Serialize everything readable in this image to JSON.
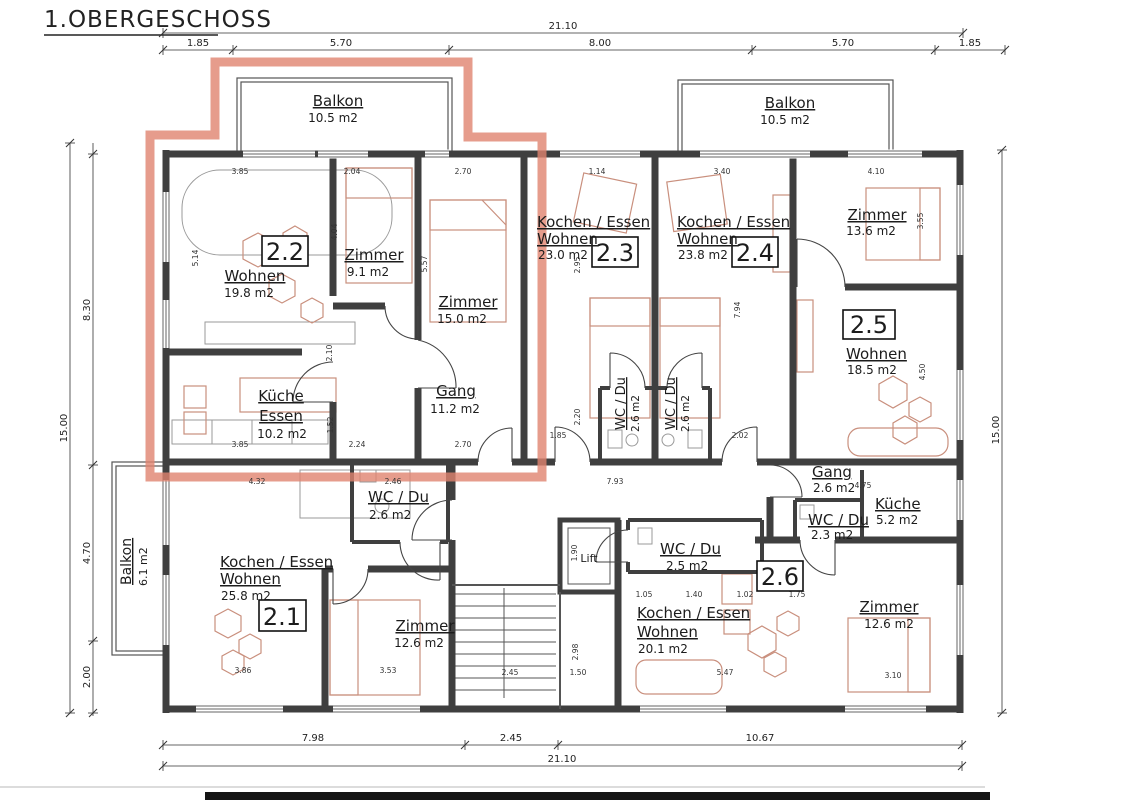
{
  "title": "1.OBERGESCHOSS",
  "highlight": {
    "unit": "2.2",
    "color": "#e0836f"
  },
  "units": [
    {
      "no": "2.1"
    },
    {
      "no": "2.2"
    },
    {
      "no": "2.3"
    },
    {
      "no": "2.4"
    },
    {
      "no": "2.5"
    },
    {
      "no": "2.6"
    }
  ],
  "rooms": [
    {
      "name": "Balkon",
      "area": "10.5 m2"
    },
    {
      "name": "Balkon",
      "area": "10.5 m2"
    },
    {
      "name": "Wohnen",
      "area": "19.8 m2"
    },
    {
      "name": "Zimmer",
      "area": "9.1 m2"
    },
    {
      "name": "Zimmer",
      "area": "15.0 m2"
    },
    {
      "name": "Küche",
      "name2": "Essen",
      "area": "10.2 m2"
    },
    {
      "name": "Gang",
      "area": "11.2 m2"
    },
    {
      "name": "Kochen / Essen",
      "name2": "Wohnen",
      "area": "23.0 m2"
    },
    {
      "name": "WC / Du",
      "area": "2.6 m2"
    },
    {
      "name": "Kochen / Essen",
      "name2": "Wohnen",
      "area": "23.8 m2"
    },
    {
      "name": "WC / Du",
      "area": "2.6 m2"
    },
    {
      "name": "Zimmer",
      "area": "13.6 m2"
    },
    {
      "name": "Wohnen",
      "area": "18.5 m2"
    },
    {
      "name": "Gang",
      "area": "2.6 m2"
    },
    {
      "name": "Küche",
      "area": "5.2 m2"
    },
    {
      "name": "WC / Du",
      "area": "2.3 m2"
    },
    {
      "name": "Kochen / Essen",
      "name2": "Wohnen",
      "area": "25.8 m2"
    },
    {
      "name": "WC / Du",
      "area": "2.6 m2"
    },
    {
      "name": "Zimmer",
      "area": "12.6 m2"
    },
    {
      "name": "Balkon",
      "area": "6.1 m2"
    },
    {
      "name": "WC / Du",
      "area": "2.5 m2"
    },
    {
      "name": "Kochen / Essen",
      "name2": "Wohnen",
      "area": "20.1 m2"
    },
    {
      "name": "Zimmer",
      "area": "12.6 m2"
    },
    {
      "name": "Lift"
    }
  ],
  "dims": {
    "top_total": "21.10",
    "top_segments": [
      "1.85",
      "5.70",
      "8.00",
      "5.70",
      "1.85"
    ],
    "left_total": "15.00",
    "left_segments": [
      "8.30",
      "4.70",
      "2.00"
    ],
    "right_total": "15.00",
    "bottom_segments": [
      "7.98",
      "2.45",
      "10.67"
    ],
    "bottom_total": "21.10"
  },
  "minor_dims": [
    {
      "t": "3.85"
    },
    {
      "t": "2.04"
    },
    {
      "t": "2.70"
    },
    {
      "t": "1.14"
    },
    {
      "t": "3.40"
    },
    {
      "t": "4.10"
    },
    {
      "t": "3.85"
    },
    {
      "t": "2.24"
    },
    {
      "t": "2.70"
    },
    {
      "t": "1.85"
    },
    {
      "t": "2.02"
    },
    {
      "t": "4.32"
    },
    {
      "t": "2.46"
    },
    {
      "t": "7.93"
    },
    {
      "t": "4.75"
    },
    {
      "t": "1.05"
    },
    {
      "t": "1.40"
    },
    {
      "t": "1.02"
    },
    {
      "t": "1.75"
    },
    {
      "t": "3.86"
    },
    {
      "t": "3.53"
    },
    {
      "t": "2.45"
    },
    {
      "t": "1.50"
    },
    {
      "t": "5.47"
    },
    {
      "t": "3.10"
    },
    {
      "t": "4.04"
    },
    {
      "t": "5.57"
    },
    {
      "t": "2.10"
    },
    {
      "t": "1.52"
    },
    {
      "t": "5.14"
    },
    {
      "t": "2.95"
    },
    {
      "t": "7.94"
    },
    {
      "t": "2.20"
    },
    {
      "t": "3.55"
    },
    {
      "t": "4.50"
    },
    {
      "t": "1.90"
    },
    {
      "t": "2.98"
    }
  ]
}
